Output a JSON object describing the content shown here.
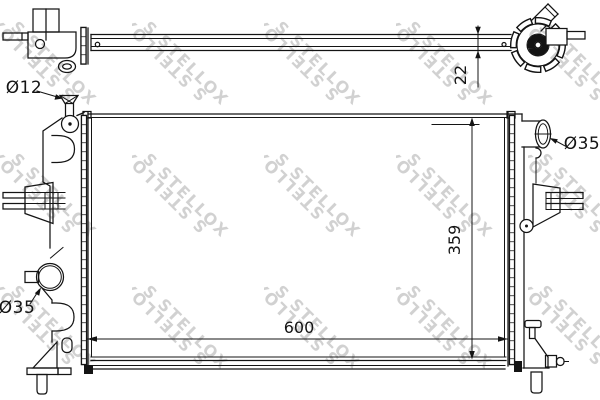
{
  "watermark": {
    "text": "STELLOX",
    "logo": "S"
  },
  "colors": {
    "ink": "#141414",
    "watermark_gray": "#cccccc",
    "background": "#ffffff"
  },
  "dims": {
    "core_width": "600",
    "core_height": "359",
    "top_depth": "22",
    "filler_neck": "Ø12",
    "left_port": "Ø35",
    "right_port": "Ø35"
  }
}
